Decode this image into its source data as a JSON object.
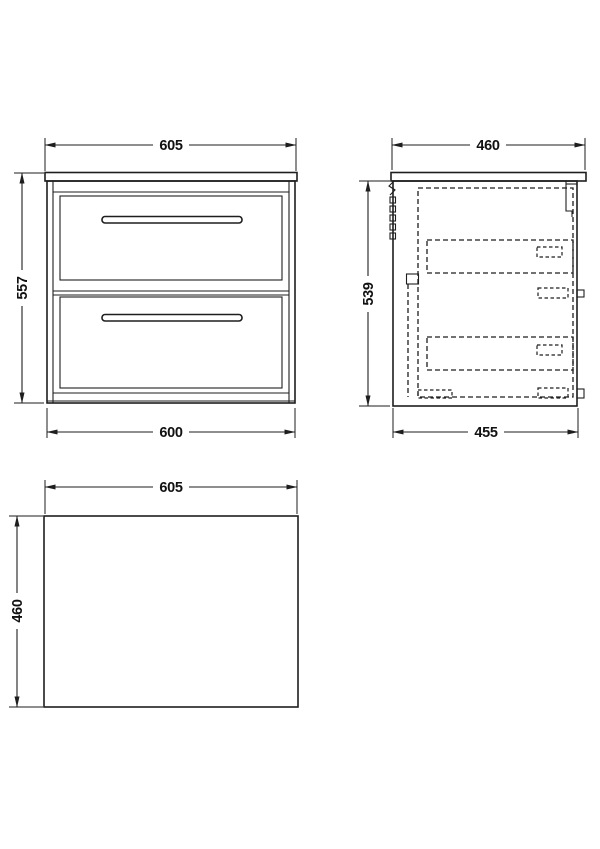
{
  "drawing": {
    "type": "technical-dimension-drawing",
    "colors": {
      "line": "#1e1e1e",
      "background": "#ffffff"
    },
    "views": {
      "front": {
        "dim_top": "605",
        "dim_left": "557",
        "dim_bottom": "600"
      },
      "side": {
        "dim_top": "460",
        "dim_left": "539",
        "dim_bottom": "455"
      },
      "plan": {
        "dim_top": "605",
        "dim_left": "460"
      }
    }
  }
}
